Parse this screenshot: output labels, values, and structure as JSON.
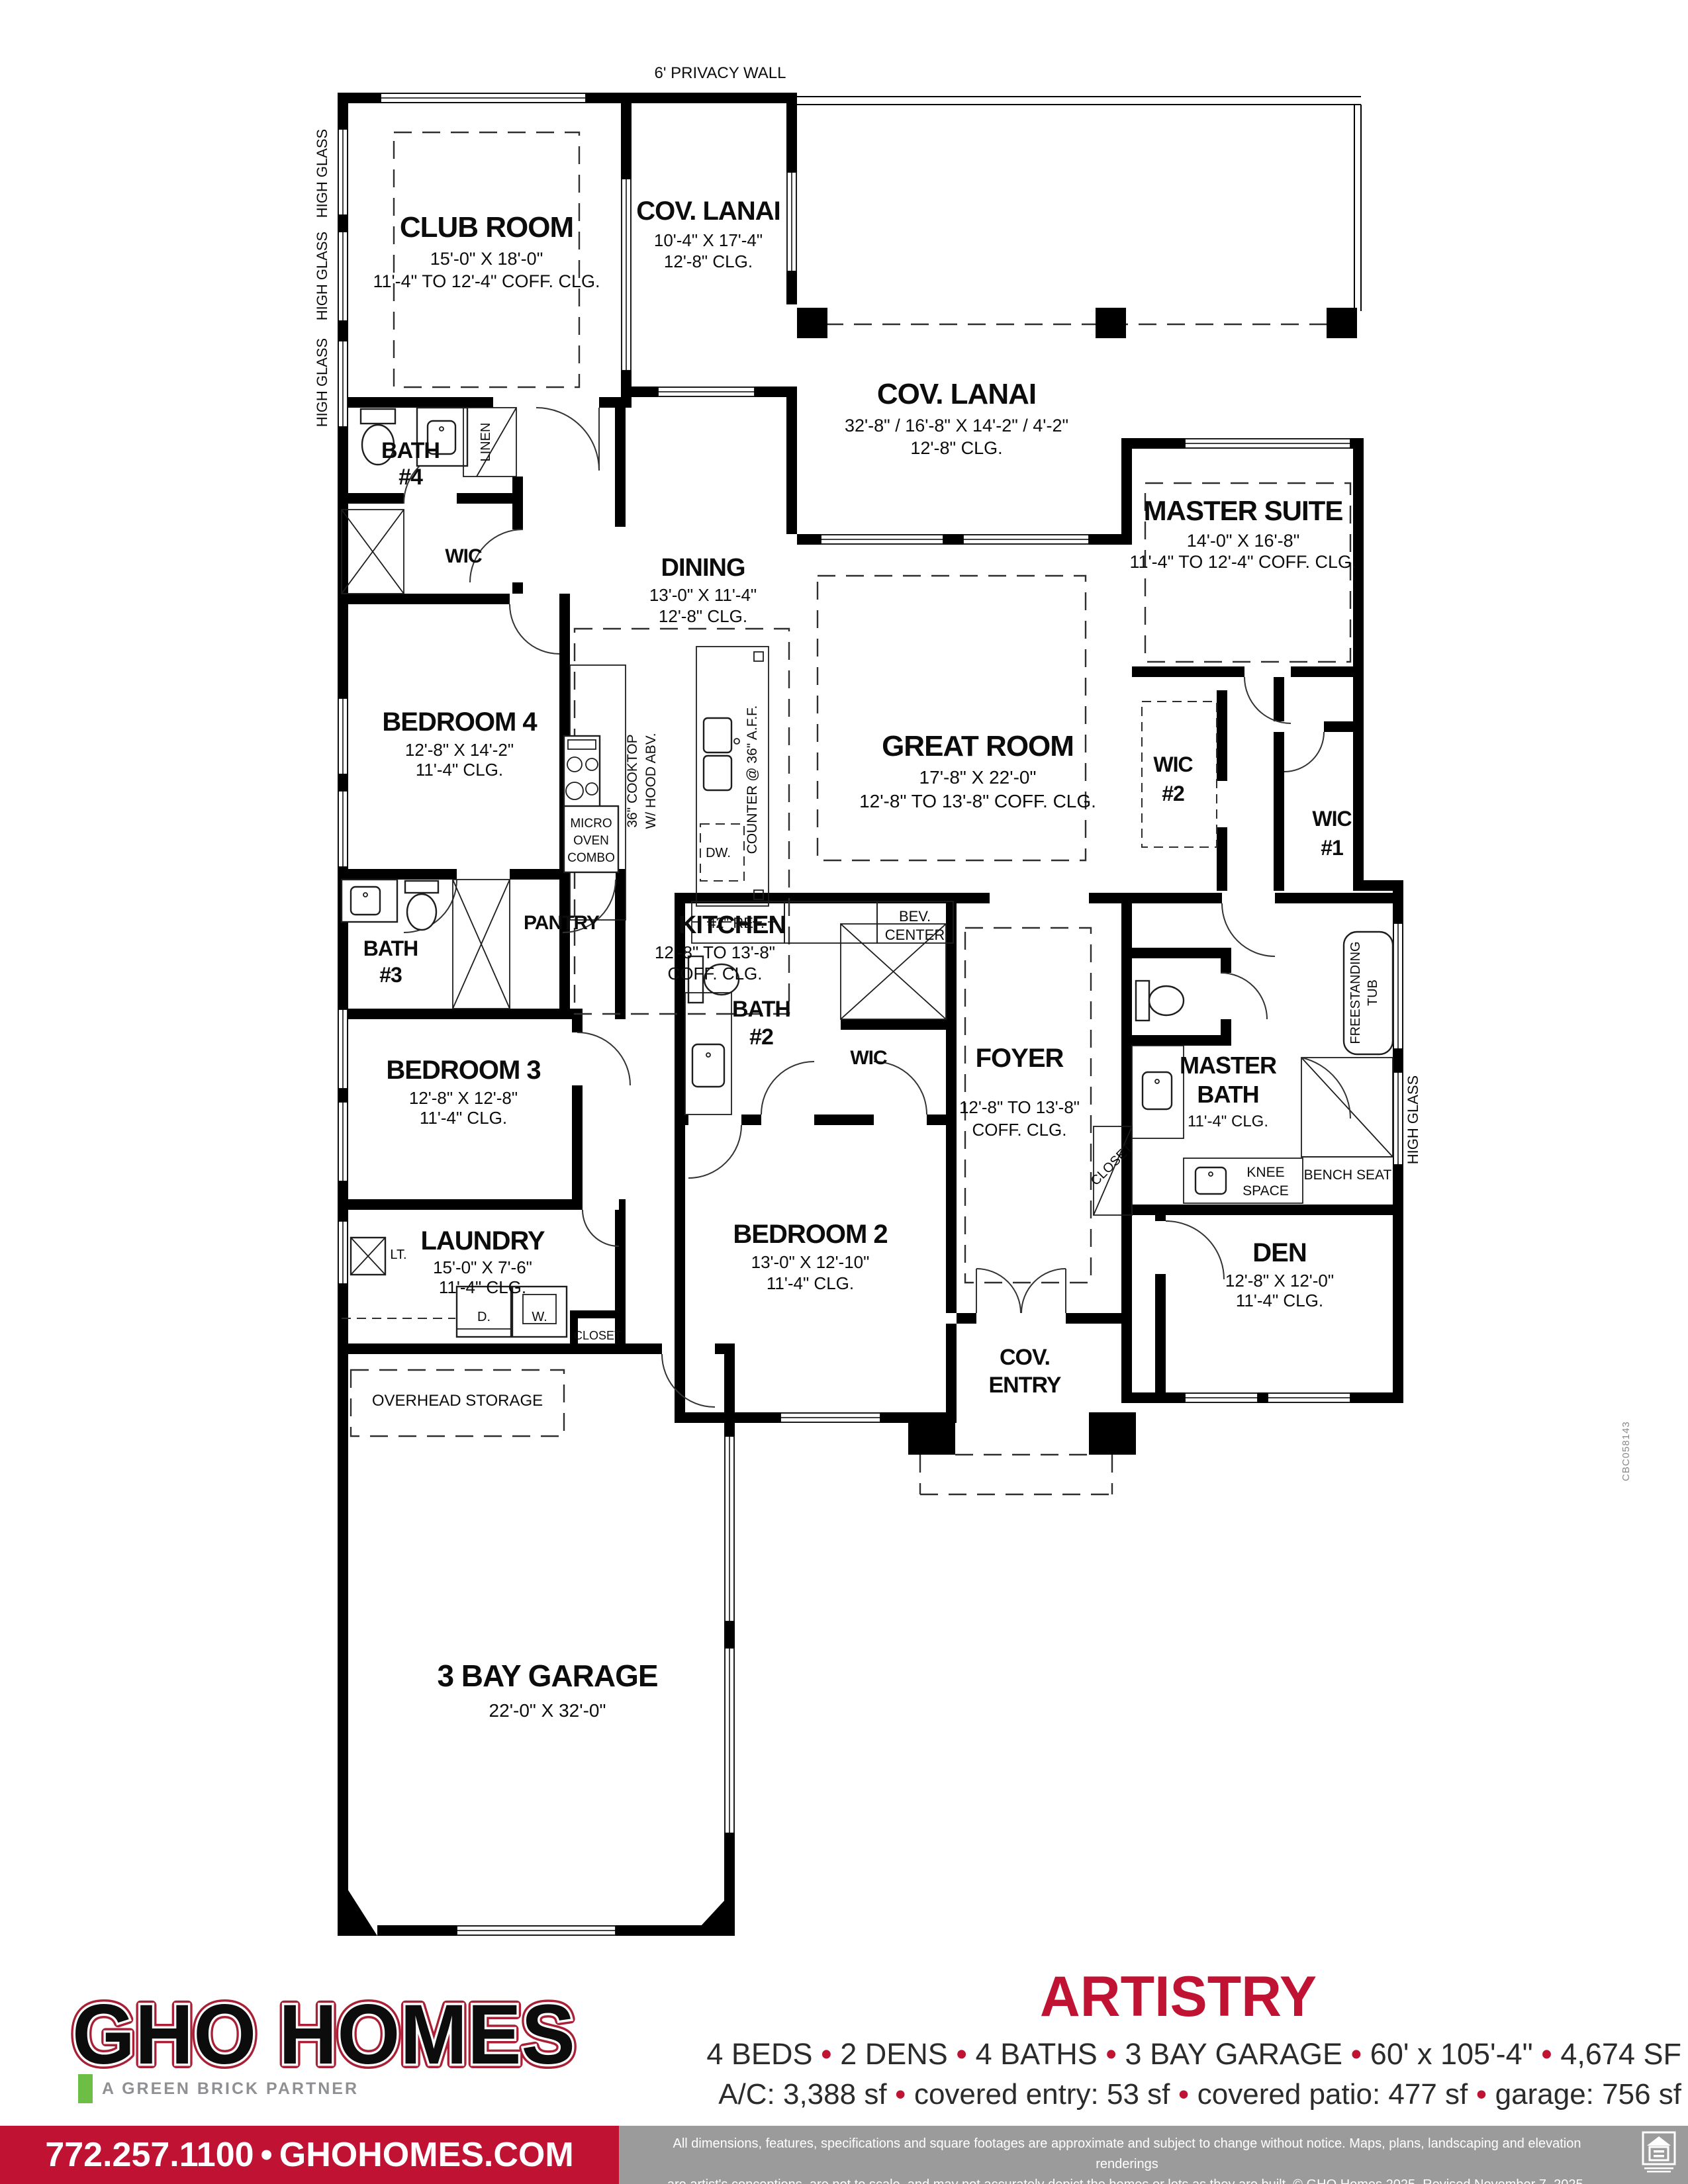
{
  "colors": {
    "accent_red": "#C01334",
    "brand_navy": "#1F2A52",
    "partner_green": "#6CBE45",
    "gray_bar": "#9B9B9B"
  },
  "plan": {
    "privacy_wall_label": "6' PRIVACY WALL",
    "high_glass_label": "HIGH GLASS",
    "license": "CBC058143",
    "rooms": {
      "club_room": {
        "name": "CLUB ROOM",
        "size": "15'-0\" X 18'-0\"",
        "ceiling": "11'-4\" TO 12'-4\" COFF. CLG."
      },
      "cov_lanai_top": {
        "name": "COV. LANAI",
        "size": "10'-4\" X 17'-4\"",
        "ceiling": "12'-8\" CLG."
      },
      "cov_lanai": {
        "name": "COV. LANAI",
        "size": "32'-8\" / 16'-8\" X 14'-2\" / 4'-2\"",
        "ceiling": "12'-8\" CLG."
      },
      "master_suite": {
        "name": "MASTER SUITE",
        "size": "14'-0\" X 16'-8\"",
        "ceiling": "11'-4\" TO 12'-4\" COFF. CLG."
      },
      "dining": {
        "name": "DINING",
        "size": "13'-0\" X 11'-4\"",
        "ceiling": "12'-8\" CLG."
      },
      "great_room": {
        "name": "GREAT ROOM",
        "size": "17'-8\" X 22'-0\"",
        "ceiling": "12'-8\" TO 13'-8\" COFF. CLG."
      },
      "kitchen": {
        "name": "KITCHEN",
        "size": "12'-8\" TO 13'-8\"",
        "ceiling": "COFF. CLG."
      },
      "bedroom_4": {
        "name": "BEDROOM 4",
        "size": "12'-8\" X 14'-2\"",
        "ceiling": "11'-4\" CLG."
      },
      "bedroom_3": {
        "name": "BEDROOM 3",
        "size": "12'-8\" X 12'-8\"",
        "ceiling": "11'-4\" CLG."
      },
      "bedroom_2": {
        "name": "BEDROOM 2",
        "size": "13'-0\" X 12'-10\"",
        "ceiling": "11'-4\" CLG."
      },
      "den": {
        "name": "DEN",
        "size": "12'-8\" X 12'-0\"",
        "ceiling": "11'-4\" CLG."
      },
      "laundry": {
        "name": "LAUNDRY",
        "size": "15'-0\" X 7'-6\"",
        "ceiling": "11'-4\" CLG."
      },
      "foyer": {
        "name": "FOYER",
        "size": "12'-8\" TO 13'-8\"",
        "ceiling": "COFF. CLG."
      },
      "master_bath": {
        "name_l1": "MASTER",
        "name_l2": "BATH",
        "ceiling": "11'-4\" CLG."
      },
      "garage": {
        "name": "3 BAY GARAGE",
        "size": "22'-0\" X 32'-0\""
      },
      "bath_4": {
        "l1": "BATH",
        "l2": "#4"
      },
      "bath_3": {
        "l1": "BATH",
        "l2": "#3"
      },
      "bath_2": {
        "l1": "BATH",
        "l2": "#2"
      },
      "wic": "WIC",
      "wic_1": {
        "l1": "WIC",
        "l2": "#1"
      },
      "wic_2": {
        "l1": "WIC",
        "l2": "#2"
      },
      "pantry": "PANTRY",
      "cov_entry": {
        "l1": "COV.",
        "l2": "ENTRY"
      }
    },
    "fixtures": {
      "linen": "LINEN",
      "closet": "CLOSET",
      "overhead_storage": "OVERHEAD STORAGE",
      "ref": "42\" REF.",
      "bev_l1": "BEV.",
      "bev_l2": "CENTER",
      "counter": "COUNTER @ 36\" A.F.F.",
      "cooktop_l1": "36\" COOKTOP",
      "cooktop_l2": "W/ HOOD ABV.",
      "micro_l1": "MICRO",
      "micro_l2": "OVEN",
      "micro_l3": "COMBO",
      "dw": "DW.",
      "lt": "LT.",
      "dryer": "D.",
      "washer": "W.",
      "knee_l1": "KNEE",
      "knee_l2": "SPACE",
      "bench": "BENCH SEAT",
      "tub_l1": "FREESTANDING",
      "tub_l2": "TUB"
    }
  },
  "footer": {
    "brand": "GHO HOMES",
    "partner": "A GREEN BRICK PARTNER",
    "plan_name": "ARTISTRY",
    "specs_line1": [
      "4 BEDS",
      "2 DENS",
      "4 BATHS",
      "3 BAY GARAGE",
      "60' x 105'-4\"",
      "4,674 SF"
    ],
    "specs_line2": [
      "A/C: 3,388 sf",
      "covered entry: 53 sf",
      "covered patio: 477 sf",
      "garage: 756 sf"
    ],
    "contact": [
      "772.257.1100",
      "GHOHOMES.COM"
    ],
    "disclaimer_l1": "All dimensions, features, specifications and square footages are approximate and subject to change without notice. Maps, plans, landscaping and elevation renderings",
    "disclaimer_l2": "are artist's conceptions, are not to scale, and may not accurately depict the homes or lots as they are built. © GHO Homes 2025. Revised November 7, 2025."
  }
}
